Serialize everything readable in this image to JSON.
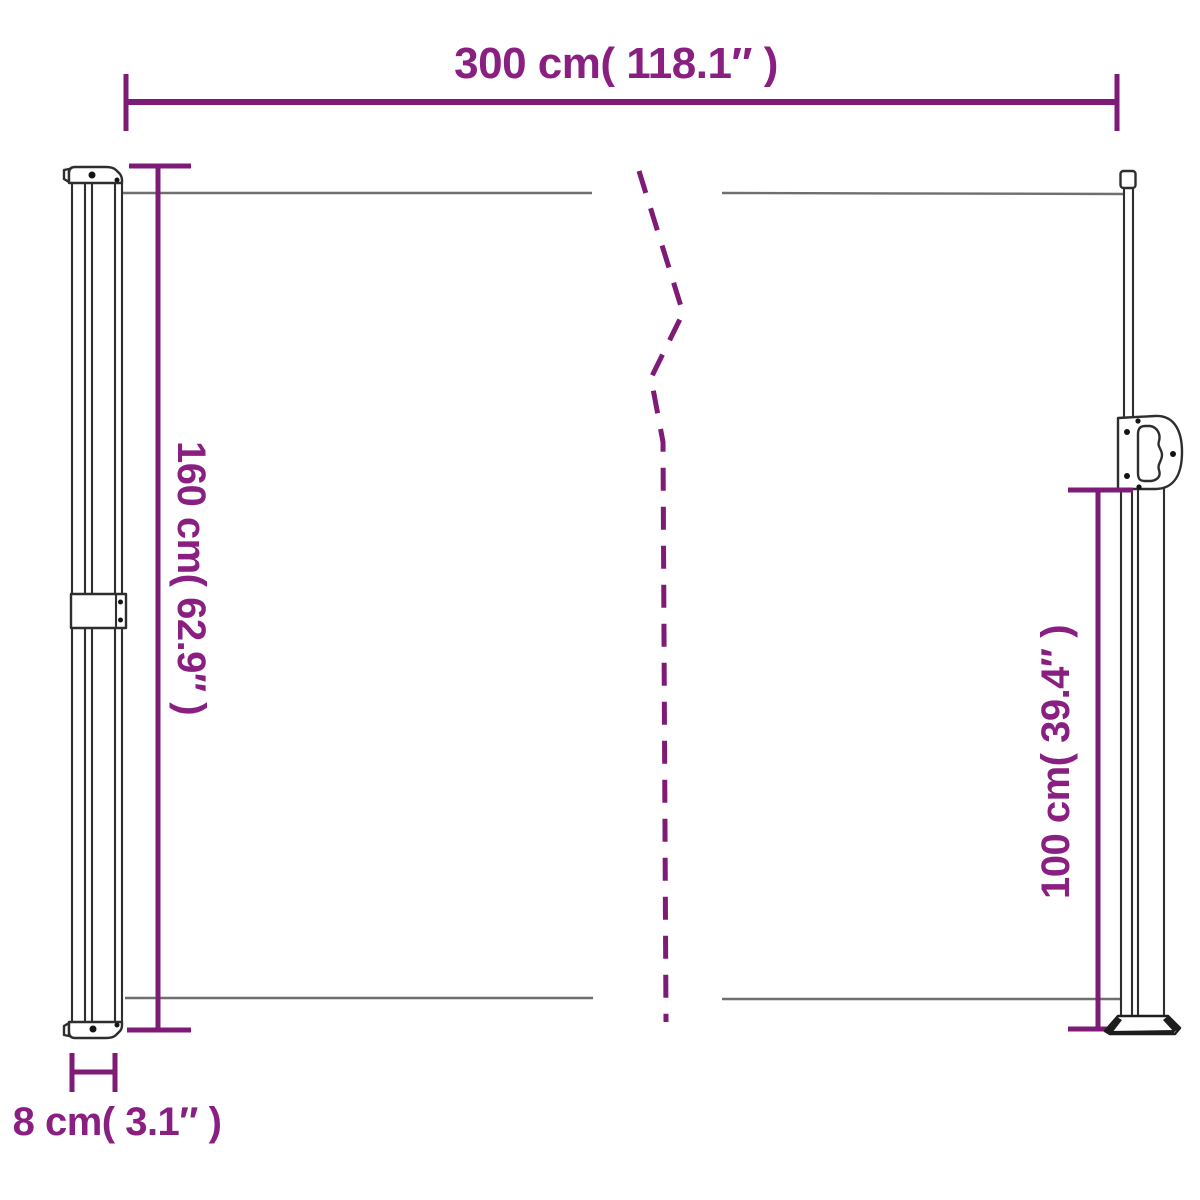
{
  "diagram": {
    "type": "product-dimension-diagram",
    "dimensions": {
      "width": "300 cm( 118.1″ )",
      "height_left": "160 cm( 62.9″ )",
      "height_right": "100 cm( 39.4″ )",
      "depth": "8 cm( 3.1″ )"
    },
    "colors": {
      "dimension_line": "#7e1b76",
      "dimension_text": "#8a1f82",
      "fabric_line": "#6f6f6f",
      "outline": "#2e2e2e",
      "background": "#ffffff"
    }
  }
}
